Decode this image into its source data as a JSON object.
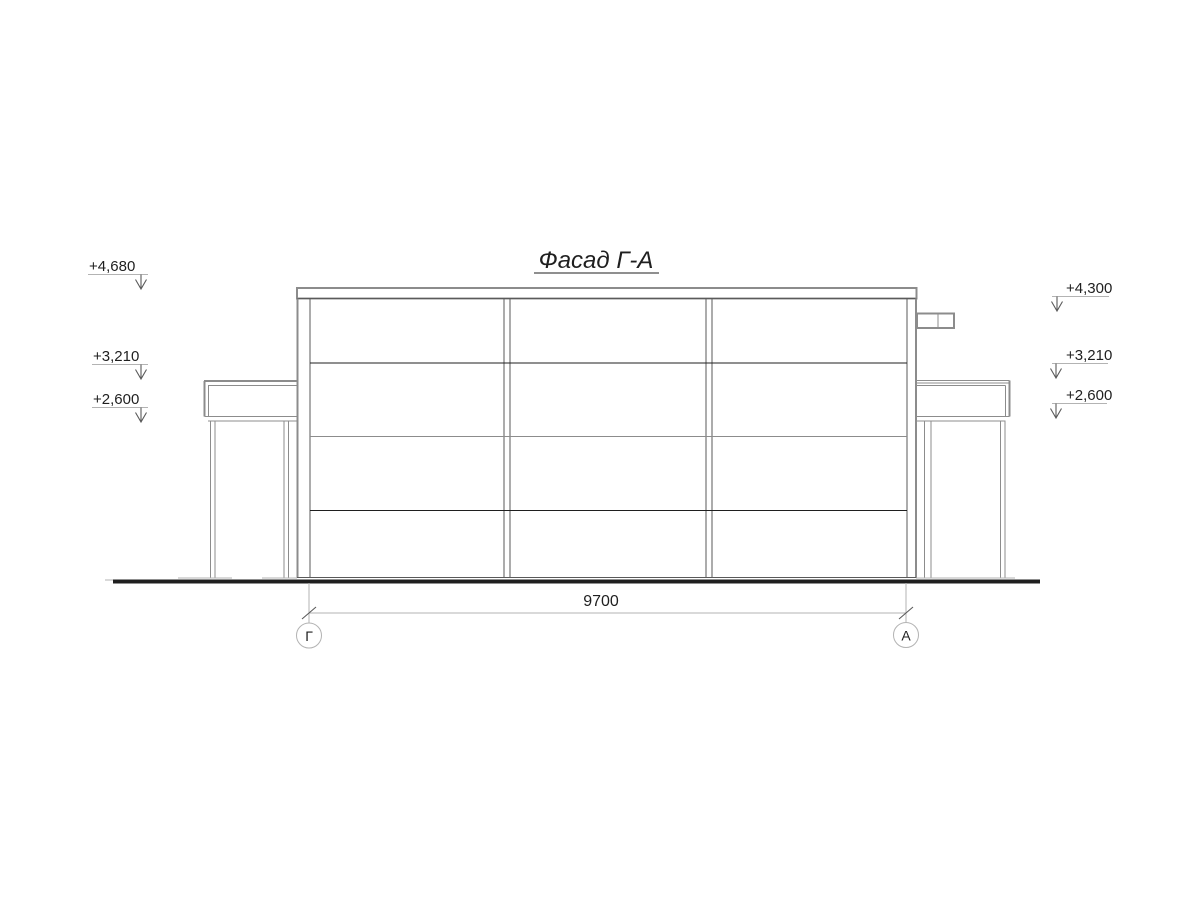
{
  "drawing": {
    "title": "Фасад Г-А",
    "dimension": {
      "value": "9700"
    },
    "axes": {
      "left": {
        "label": "Г"
      },
      "right": {
        "label": "А"
      }
    },
    "elevation_marks_left": [
      {
        "value": "+4,680"
      },
      {
        "value": "+3,210"
      },
      {
        "value": "+2,600"
      }
    ],
    "elevation_marks_right": [
      {
        "value": "+4,300"
      },
      {
        "value": "+3,210"
      },
      {
        "value": "+2,600"
      }
    ],
    "colors": {
      "background": "#ffffff",
      "line_dark": "#1f1f1f",
      "line_mid": "#5a5a5a",
      "line_gray": "#8c8c8c",
      "line_light": "#b3b3b3"
    }
  }
}
